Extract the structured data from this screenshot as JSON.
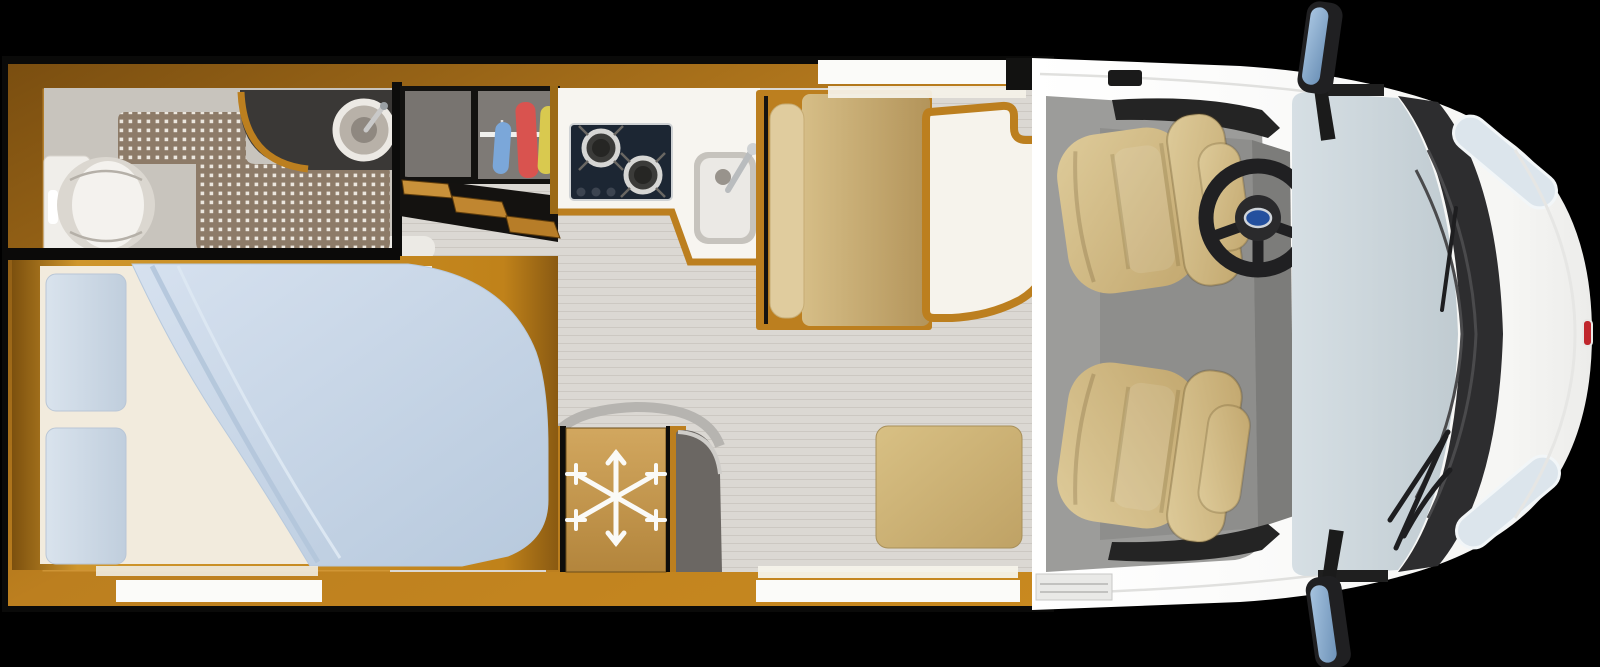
{
  "scene": {
    "type": "motorhome-floorplan-top-view",
    "vehicle_front": "right",
    "no_visible_text": true
  },
  "colors": {
    "background": "#000000",
    "wood_frame": "#b57a1c",
    "wood_light": "#d89b35",
    "wood_dark": "#7a4e10",
    "living_floor": "#dbd8d3",
    "bathroom_floor": "#c8c4bd",
    "shower_mat": "#8d7b68",
    "mat_dot": "#ece7de",
    "vanity_counter": "#3a3836",
    "hob": "#1c2633",
    "kitchen_counter": "#f7f5f0",
    "sink_basin": "#ebe9e5",
    "bed_sheet": "#f2ebdd",
    "duvet_blue": "#c6d5e6",
    "pillow_blue": "#cdd9e6",
    "bench_tan": "#c9b078",
    "backrest_tan": "#e0cc9e",
    "ottoman_tan": "#cdb375",
    "table_top": "#f6f3ec",
    "fridge_door": "#c49a56",
    "snowflake": "#fafaf7",
    "gray_panel": "#6b6763",
    "cab_floor": "#9c9c9a",
    "cab_mat": "#8e8e8c",
    "cab_seat": "#d2bc8b",
    "body_white": "#fdfdfd",
    "windshield": "#ccd7dd",
    "wiper_cowl": "#2d2d2f",
    "dashboard": "#242424",
    "steering_wheel": "#202022",
    "badge_blue": "#24509e",
    "badge_red": "#c0272d",
    "mirror_glass": "#8fb4d8",
    "headlight": "#dce5ec",
    "clothes_blue": "#7ba7d9",
    "clothes_red": "#d9534f",
    "clothes_yellow": "#d9c94f",
    "window_white": "#fbfbf9"
  },
  "icons": {
    "fridge": "snowflake-icon",
    "steering_hub": "brand-badge-oval"
  },
  "areas": {
    "bathroom": [
      "toilet",
      "washbasin",
      "vanity-counter",
      "shower-mat"
    ],
    "bedroom": [
      "double-bed",
      "pillows",
      "duvet"
    ],
    "wardrobe": [
      "hanging-rail",
      "clothes-blue",
      "clothes-red",
      "clothes-yellow",
      "entry-steps"
    ],
    "kitchen": [
      "two-burner-hob",
      "kitchen-sink",
      "faucet"
    ],
    "dinette": [
      "bench-seat",
      "table",
      "ottoman"
    ],
    "appliances": [
      "refrigerator"
    ],
    "cab": [
      "driver-seat",
      "passenger-seat",
      "steering-wheel",
      "dashboard",
      "windshield",
      "wipers",
      "side-mirrors",
      "headlights",
      "entry-step"
    ],
    "windows": [
      "dinette-top-window",
      "bed-bottom-window",
      "dinette-bottom-window"
    ]
  }
}
